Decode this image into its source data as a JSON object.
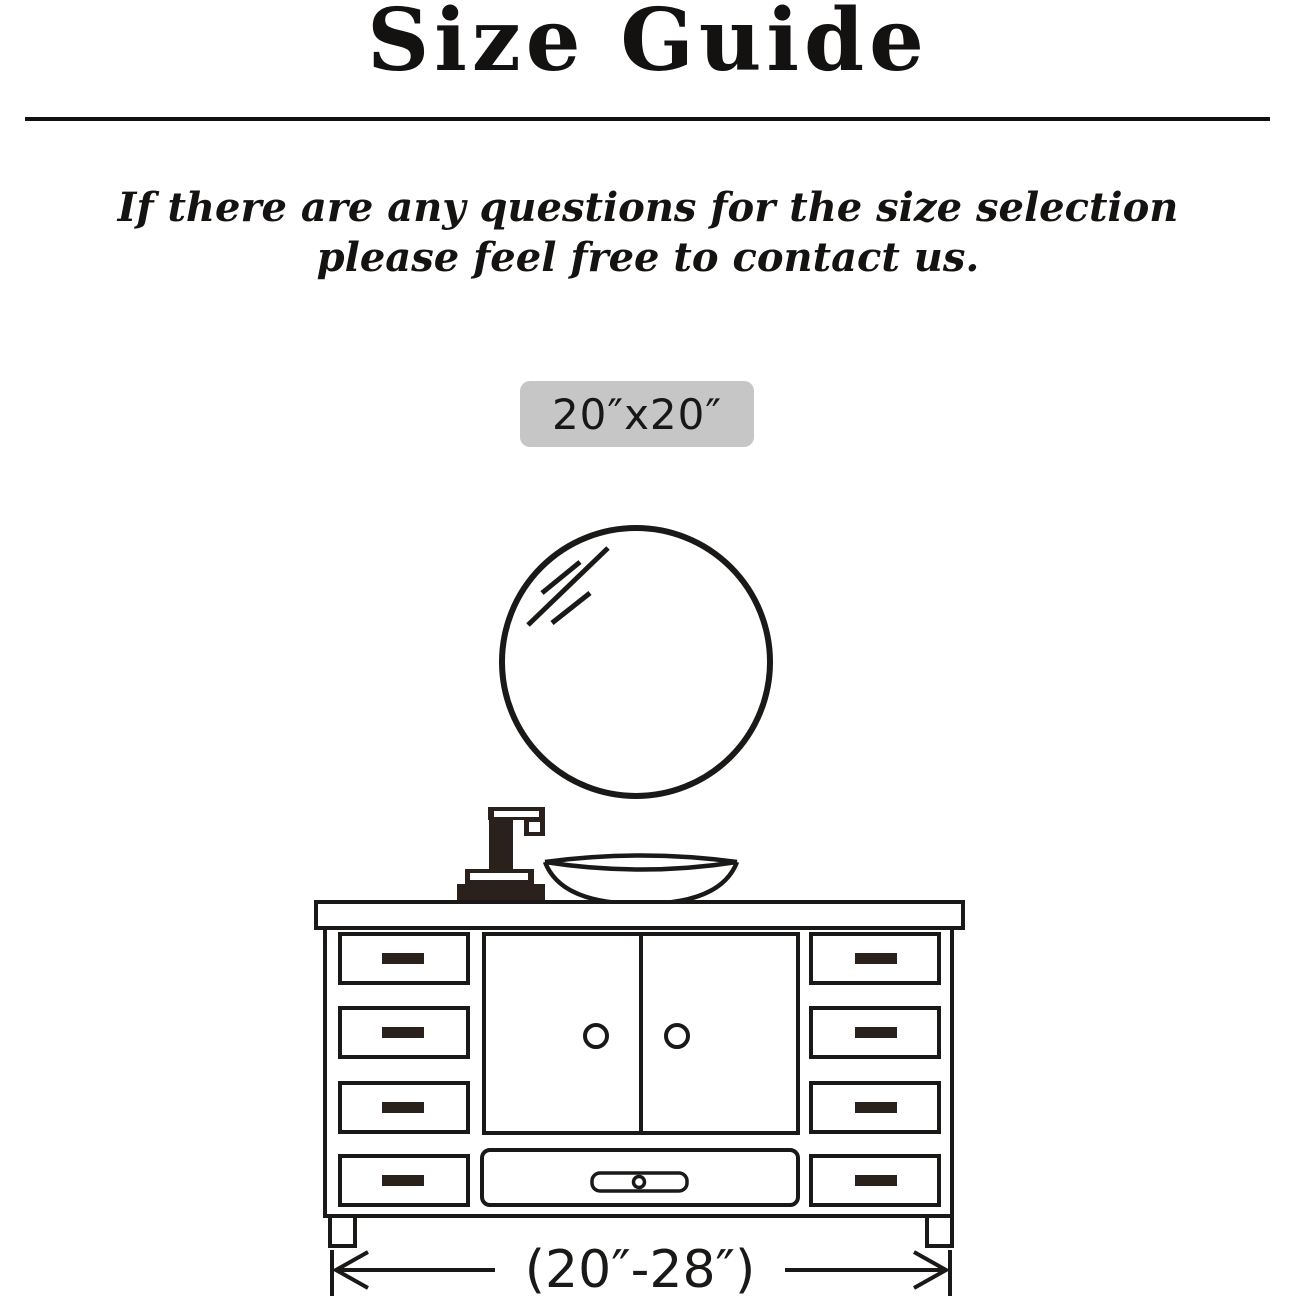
{
  "header": {
    "title": "Size Guide"
  },
  "note": {
    "line1": "If there are any questions for the size selection",
    "line2": "please feel free to contact us."
  },
  "mirror": {
    "size_label": "20″x20″"
  },
  "vanity": {
    "width_range_label": "(20″-28″)"
  },
  "colors": {
    "ink": "#1b1917",
    "faucet_fill": "#2a211c",
    "badge_bg": "#c6c6c6",
    "background": "#ffffff"
  }
}
